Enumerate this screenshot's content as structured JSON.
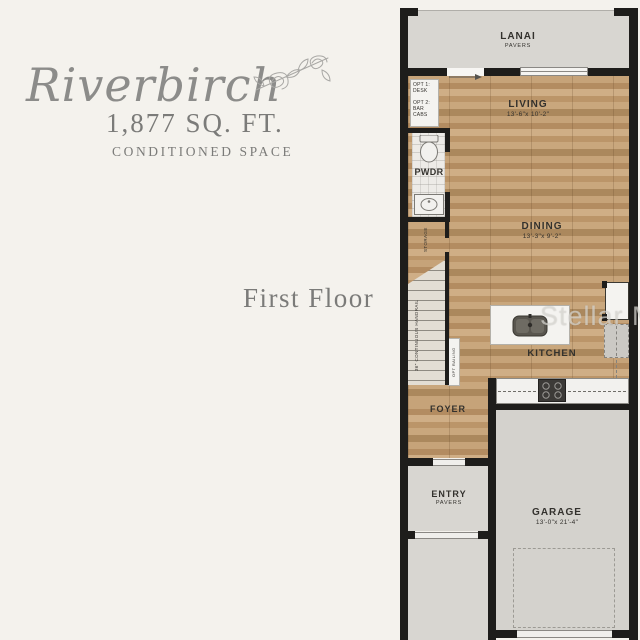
{
  "title": {
    "name": "Riverbirch",
    "sqft": "1,877 SQ. FT.",
    "space": "CONDITIONED SPACE",
    "floor": "First Floor"
  },
  "watermark": "Stellar MLS",
  "plan": {
    "lanai": {
      "label": "LANAI",
      "surface": "PAVERS"
    },
    "living": {
      "label": "LIVING",
      "dims": "13'-6\"x 10'-2\""
    },
    "dining": {
      "label": "DINING",
      "dims": "13'-3\"x 9'-2\""
    },
    "kitchen": {
      "label": "KITCHEN"
    },
    "pwdr": {
      "label": "PWDR"
    },
    "storage": {
      "label": "STORAGE"
    },
    "foyer": {
      "label": "FOYER"
    },
    "entry": {
      "label": "ENTRY",
      "surface": "PAVERS"
    },
    "garage": {
      "label": "GARAGE",
      "dims": "13'-0\"x 21'-4\""
    },
    "notes": {
      "opt_desk": "OPT 1: DESK",
      "opt_bar": "OPT 2: BAR CABS",
      "handrail": "36\" CONTINUOUS HANDRAIL",
      "railing": "OPT RAILING"
    },
    "colors": {
      "wall": "#1e1d1b",
      "wood": "#bf9c72",
      "pavers": "#d8d6d1",
      "background": "#f4f2ed"
    }
  }
}
